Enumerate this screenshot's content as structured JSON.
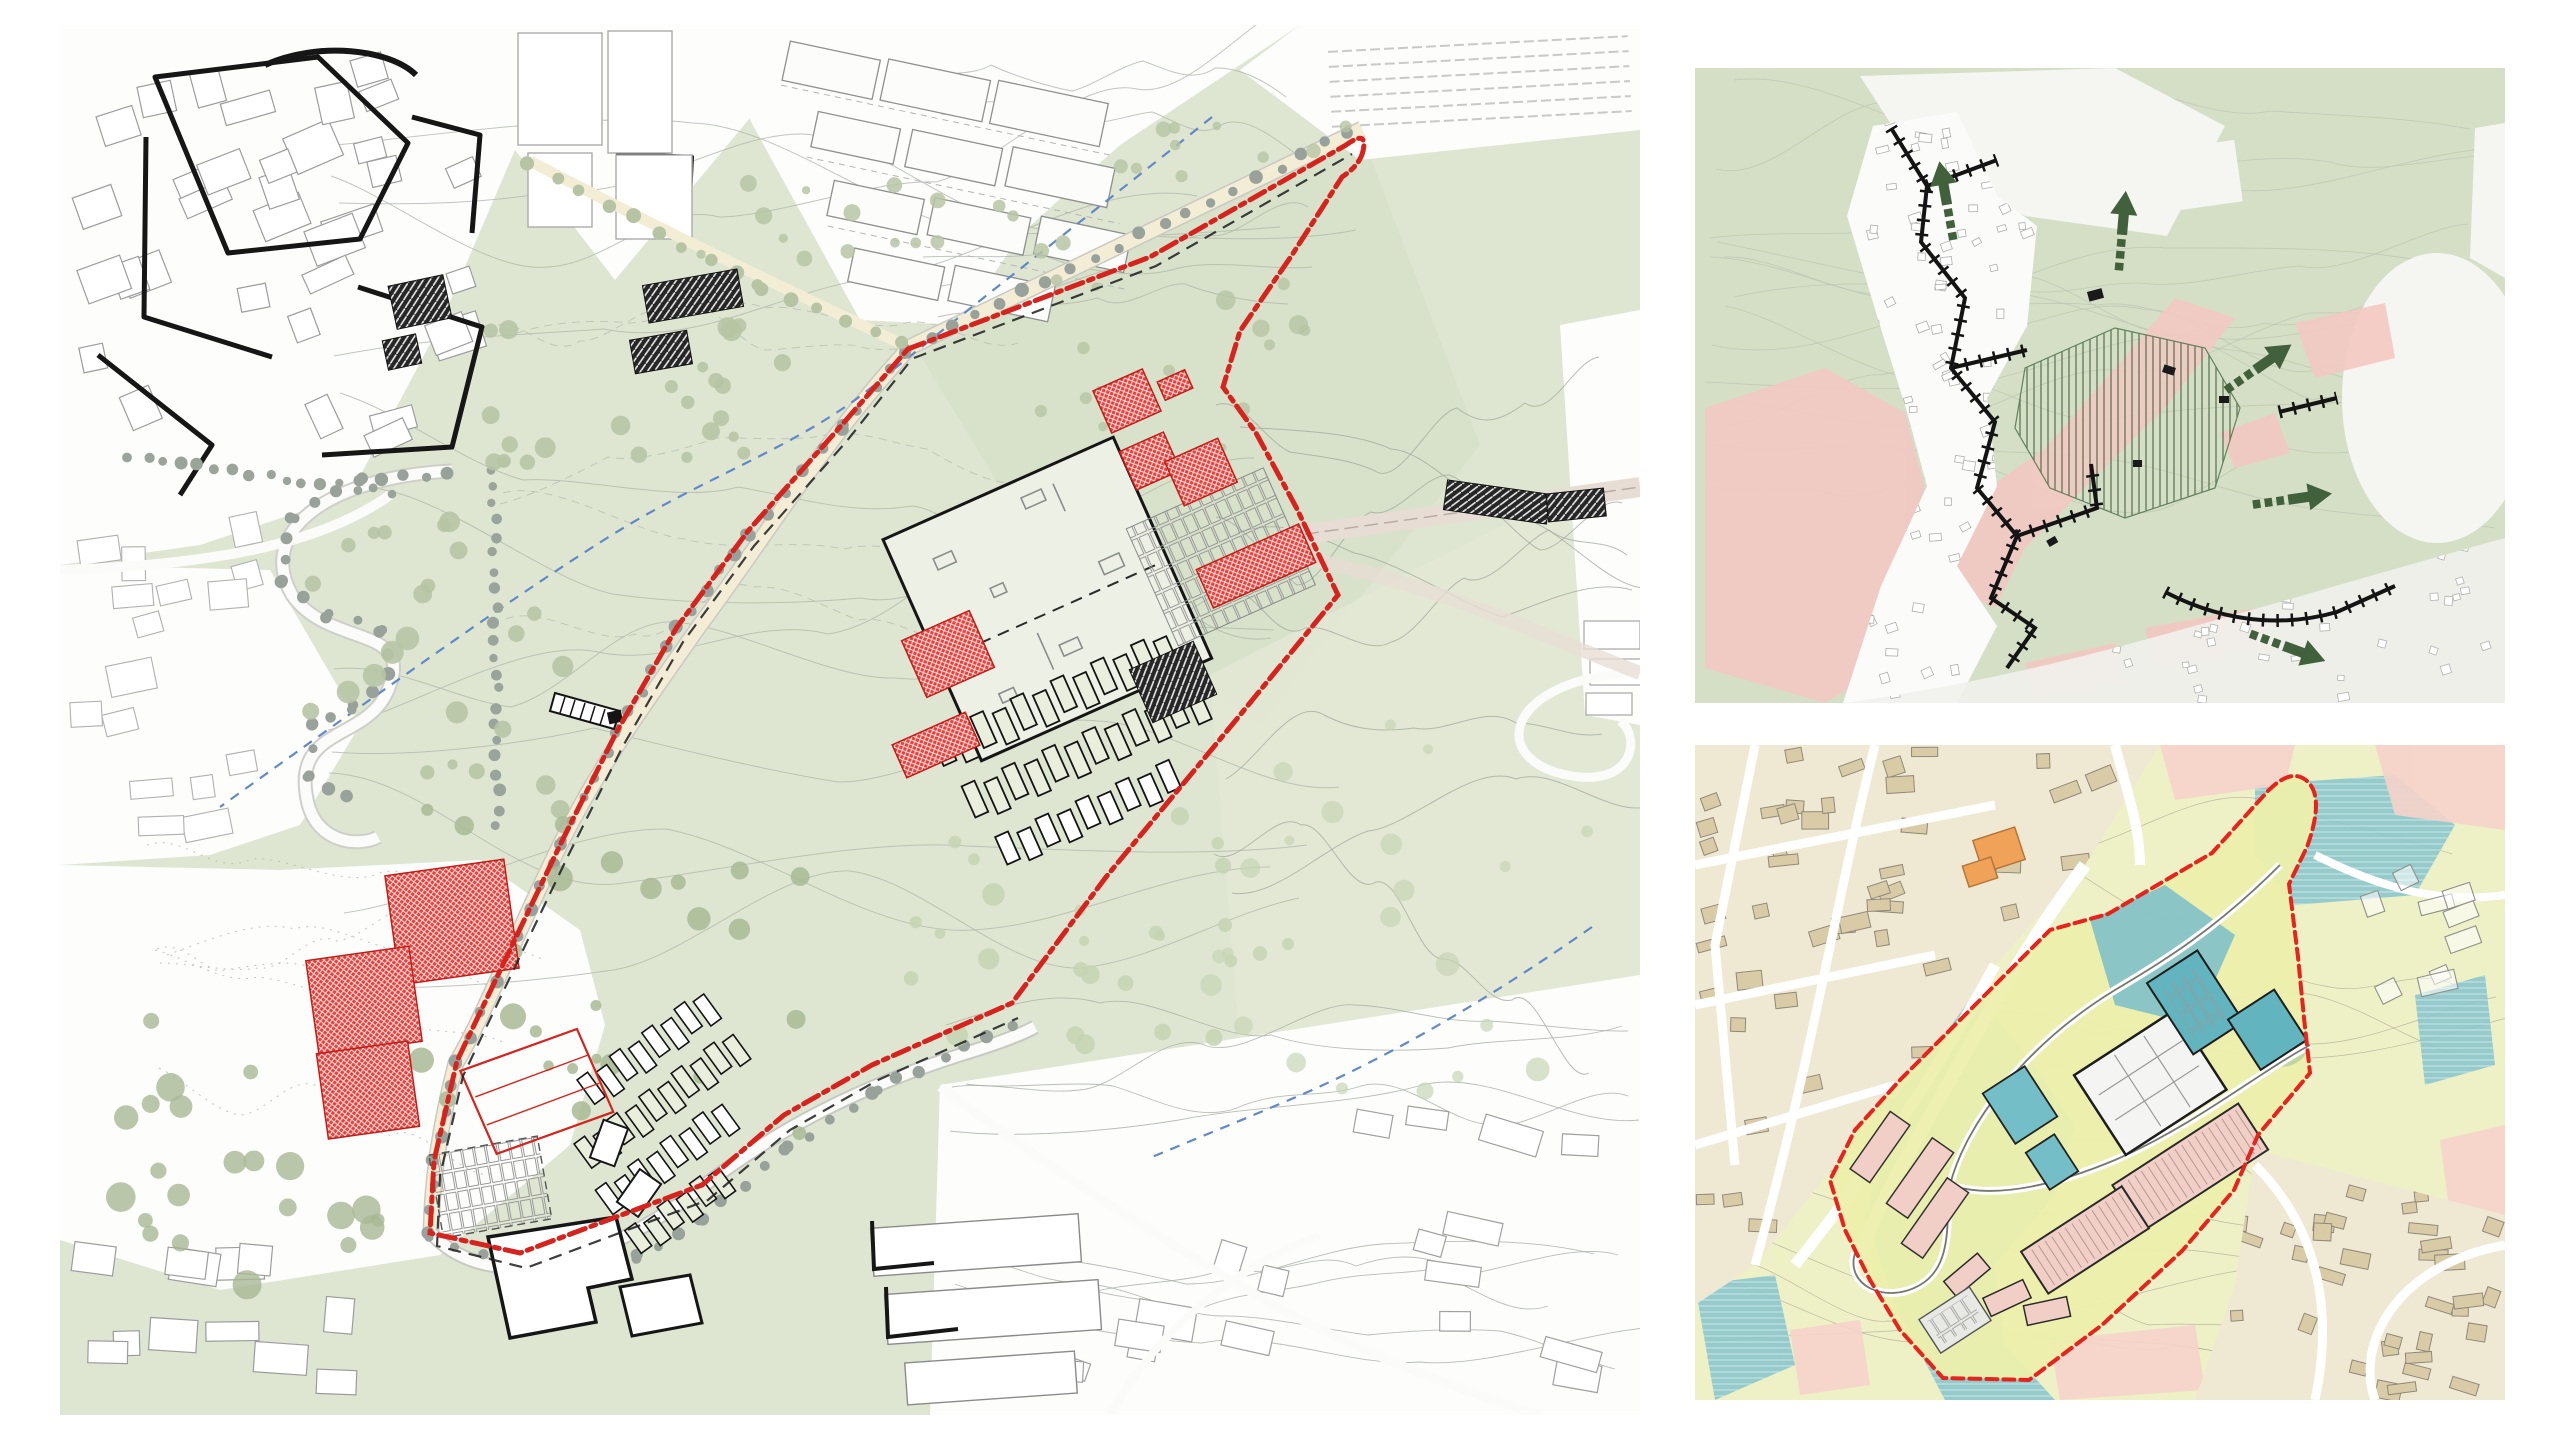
{
  "board": {
    "background": "#ffffff",
    "description": "Architectural masterplan presentation board: one large landscape site plan at left, territorial strategy map top right, zoning strategy map bottom right. No text labels are printed on the board."
  },
  "colors": {
    "paper": "#ffffff",
    "park_green": "#dee6d2",
    "park_green_light": "#e8edde",
    "slope_green": "#d6dfc5",
    "contour_gray": "#b1b9ad",
    "contour_dark": "#9aa096",
    "urban_line": "#9c9c9c",
    "bold_outline": "#161616",
    "road_cream": "#f3edd6",
    "road_edge": "#c9c9c3",
    "railway_band": "#e7ddd5",
    "tree_sage": "#b7c4a4",
    "tree_olive": "#a9b894",
    "tree_gray": "#98a29a",
    "stream_blue": "#6189c7",
    "proposed_red": "#ee3c36",
    "red_outline": "#c01d18",
    "boundary_red": "#d6231d",
    "black_building": "#262626",
    "hall_fill": "#edf0e4",
    "context_green": "#d4dfc5",
    "context_pink": "#f2c9c2",
    "arrow_green": "#41603c",
    "hatch_green": "#5d7d57",
    "wall_black": "#141414",
    "zoning_yellow": "#eef0c6",
    "site_yellow": "#ecefac",
    "teal_zone": "#8cc7cd",
    "teal_building": "#62b5bf",
    "pink_zone": "#f6d3ca",
    "pink_building": "#f2cfc6",
    "tan_fabric": "#efe9d4",
    "tan_building": "#d9cba6",
    "tan_line": "#8f897b",
    "orange_building": "#f0a258",
    "zoning_boundary_red": "#e6231c",
    "white_building": "#f4f4f2"
  },
  "panels": {
    "masterplan": {
      "name": "site-masterplan",
      "position": "left",
      "features": [
        "existing urban fabric in thin gray line",
        "bold black outlined street blocks",
        "industrial sheds top right",
        "landscape park with contour lines",
        "tree rows along roads",
        "blue dashed stream",
        "red dash-dot site boundary loop",
        "proposed buildings in red crosshatch",
        "dark hatched special buildings",
        "large central hall with dashed roof line",
        "terraced housing rows",
        "parking courts",
        "white buildings with bold outline at south"
      ]
    },
    "context": {
      "name": "territorial-strategy-map",
      "position": "top-right",
      "features": [
        "green hillside with fine contour texture",
        "historic urban fabric left in white",
        "pink pressure zones",
        "black wall lines with crossing tick marks",
        "dark green hatched agricultural field",
        "outward dark green arrows with dashed tails"
      ],
      "arrows": [
        {
          "icon": "green-arrow-icon",
          "direction": "north"
        },
        {
          "icon": "green-arrow-icon",
          "direction": "north"
        },
        {
          "icon": "green-arrow-icon",
          "direction": "north-east"
        },
        {
          "icon": "green-arrow-icon",
          "direction": "east"
        },
        {
          "icon": "green-arrow-icon",
          "direction": "south-east"
        }
      ]
    },
    "zoning": {
      "name": "zoning-strategy-map",
      "position": "bottom-right",
      "features": [
        "pale yellow terrain with contours",
        "teal water and ecology corridors",
        "pink settlement zones",
        "tan existing urban fabric with white streets",
        "orange landmark building",
        "red dashed masterplan boundary with rounded hook",
        "development parcels in teal, pink rows and white hall"
      ]
    }
  }
}
